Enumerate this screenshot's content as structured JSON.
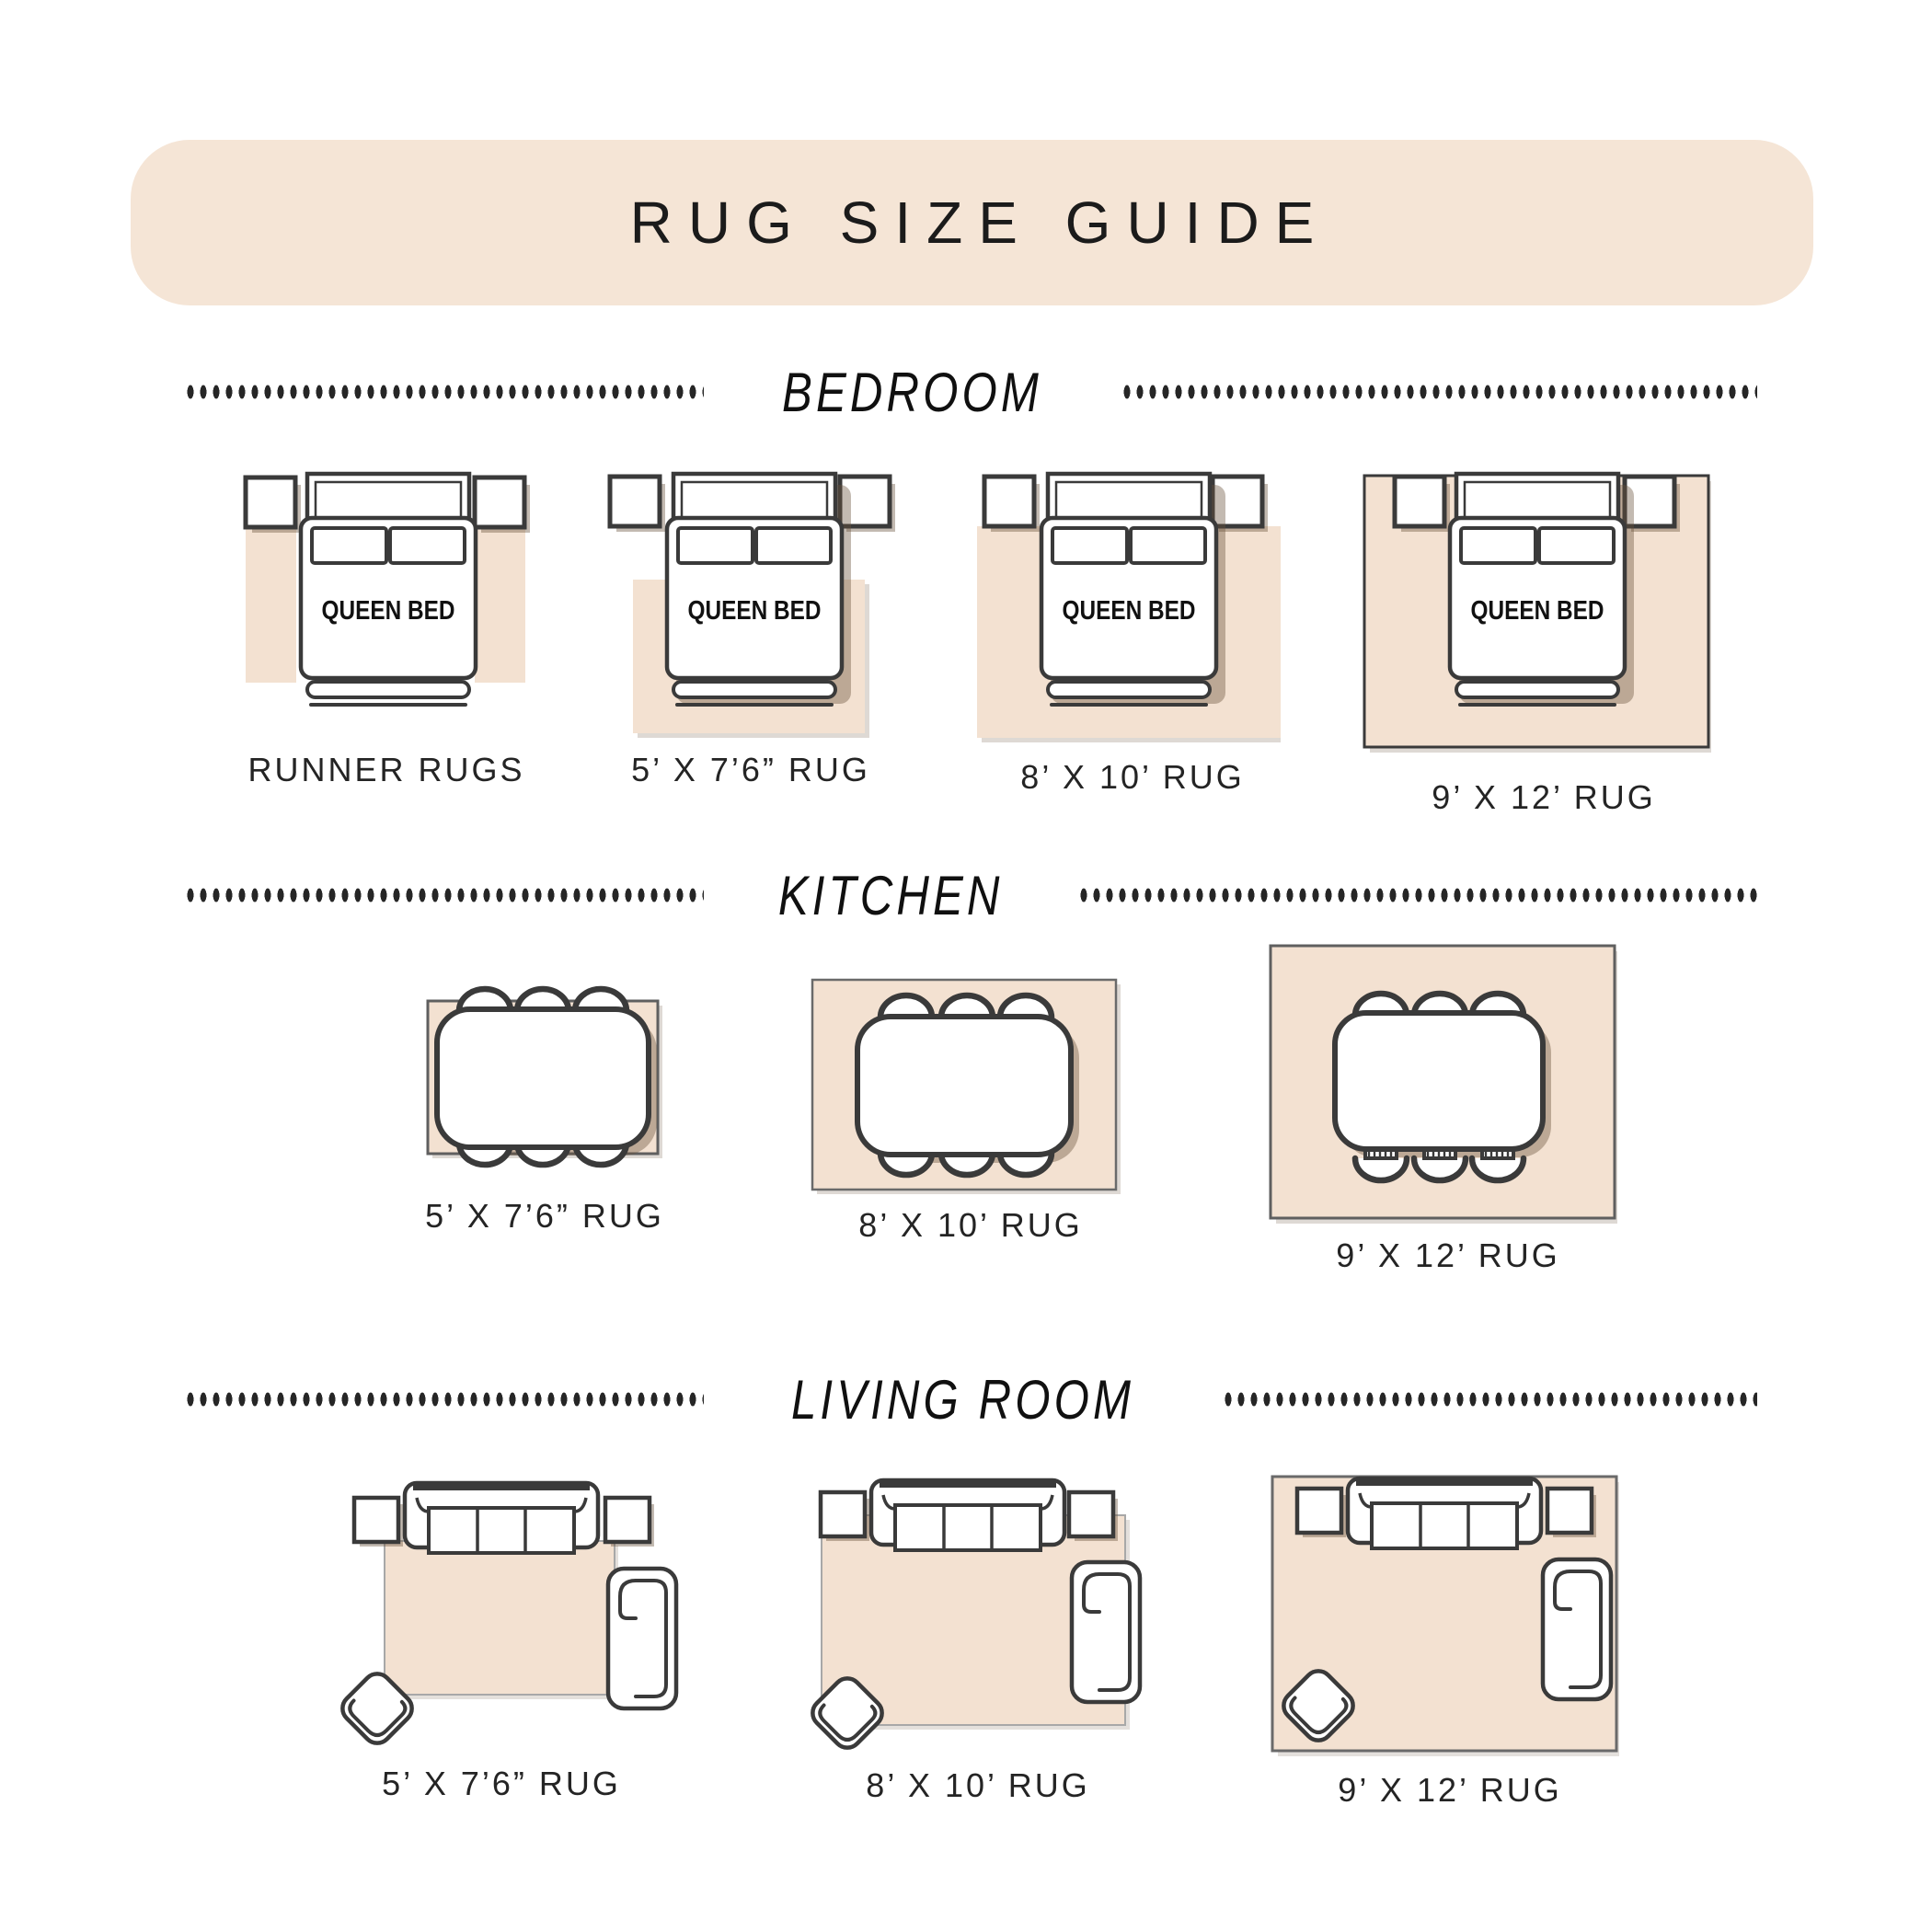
{
  "title": "RUG SIZE GUIDE",
  "bed_label": "QUEEN BED",
  "sections": [
    {
      "heading": "BEDROOM",
      "items": [
        "RUNNER RUGS",
        "5’ X 7’6” RUG",
        "8’ X 10’ RUG",
        "9’ X 12’ RUG"
      ]
    },
    {
      "heading": "KITCHEN",
      "items": [
        "5’ X 7’6” RUG",
        "8’ X 10’ RUG",
        "9’ X 12’ RUG"
      ]
    },
    {
      "heading": "LIVING ROOM",
      "items": [
        "5’ X 7’6” RUG",
        "8’ X 10’ RUG",
        "9’ X 12’ RUG"
      ]
    }
  ],
  "colors": {
    "banner_bg": "#f5e5d6",
    "rug": "#f3e1d1",
    "outline": "#3a3a3a",
    "ink": "#1b1b1b",
    "dots": "#262626",
    "shadow": "rgba(106,82,60,0.4)"
  }
}
